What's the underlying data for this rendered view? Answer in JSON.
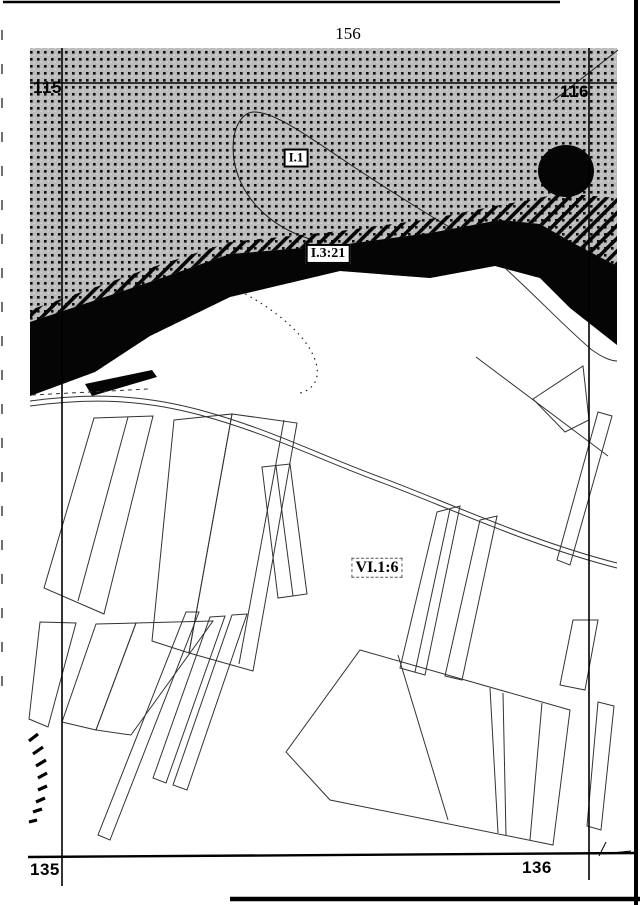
{
  "page": {
    "number": "156",
    "colors": {
      "paper": "#ffffff",
      "ink": "#000000",
      "halftone_bg": "#bcbcbc"
    }
  },
  "map": {
    "grid_labels": [
      {
        "name": "grid-label-115",
        "text": "115",
        "x": 33,
        "y": 79
      },
      {
        "name": "grid-label-116",
        "text": "116",
        "x": 560,
        "y": 83
      },
      {
        "name": "grid-label-135",
        "text": "135",
        "x": 30,
        "y": 861
      },
      {
        "name": "grid-label-136",
        "text": "136",
        "x": 522,
        "y": 859
      }
    ],
    "area_labels": [
      {
        "name": "region-label-i1",
        "text": "I.1",
        "cx": 296,
        "cy": 158,
        "style": "solid",
        "fs": 13
      },
      {
        "name": "region-label-i3-21",
        "text": "I.3:21",
        "cx": 328,
        "cy": 254,
        "style": "solid",
        "fs": 14
      },
      {
        "name": "region-label-vi1-6",
        "text": "VI.1:6",
        "cx": 377,
        "cy": 568,
        "style": "dashed",
        "fs": 16
      }
    ],
    "features": [
      {
        "name": "halftone-region",
        "type": "polygon",
        "points": "30,48 617,48 617,345 570,308 540,278 495,266 430,278 340,271 230,297 150,336 95,372 30,396",
        "fill": "dots"
      },
      {
        "name": "hill-contour-line",
        "type": "path",
        "d": "M310,239 C268,226 240,196 234,160 C230,130 241,113 253,112 C272,111 302,132 342,159 C385,188 432,217 456,231",
        "stroke": "#1a1a1a",
        "sw": 1
      },
      {
        "name": "corner-boundary-line",
        "type": "line",
        "x1": 553,
        "y1": 101,
        "x2": 618,
        "y2": 50,
        "stroke": "#1a1a1a",
        "sw": 1
      },
      {
        "name": "shore-hatch-band",
        "type": "polygon",
        "points": "30,310 150,268 230,242 340,231 430,219 500,205 535,199 560,193 617,198 617,266 575,244 540,224 500,220 430,233 340,245 230,254 150,282 30,322",
        "fill": "hatch"
      },
      {
        "name": "river-band",
        "type": "polygon",
        "points": "30,322 150,282 230,254 340,245 430,233 500,220 540,224 575,244 617,266 617,345 570,308 540,278 495,266 430,278 340,271 230,297 150,336 95,372 30,396",
        "fill": "#050505"
      },
      {
        "name": "bank-dash",
        "type": "polygon",
        "points": "85,384 152,370 157,377 92,396",
        "fill": "#050505"
      },
      {
        "name": "pond-blob",
        "type": "ellipse",
        "cx": 566,
        "cy": 171,
        "rx": 28,
        "ry": 26,
        "fill": "#050505"
      },
      {
        "name": "marsh-dotted-arc",
        "type": "path",
        "d": "M240,291 C285,315 312,342 317,367 C319,381 312,390 300,393",
        "stroke": "#222222",
        "sw": 1.2,
        "dash": "1.5 4.5"
      },
      {
        "name": "road-upper-line",
        "type": "path",
        "d": "M30,401 C90,393 140,394 200,410 C270,429 320,455 380,477 C440,499 530,541 617,563",
        "stroke": "#333333",
        "sw": 1
      },
      {
        "name": "road-lower-line",
        "type": "path",
        "d": "M30,406 C90,398 140,399 200,415 C270,434 320,460 380,482 C440,504 530,546 617,568",
        "stroke": "#333333",
        "sw": 1
      },
      {
        "name": "roadside-dashed-line",
        "type": "line",
        "x1": 32,
        "y1": 395,
        "x2": 148,
        "y2": 389,
        "stroke": "#333333",
        "sw": 1,
        "dash": "4 4"
      },
      {
        "name": "field-boundary-line",
        "type": "path",
        "d": "M505,268 C540,300 568,330 592,350 C603,358 612,361 617,361",
        "stroke": "#333333",
        "sw": 1
      },
      {
        "name": "diagonal-boundary-line",
        "type": "line",
        "x1": 476,
        "y1": 357,
        "x2": 608,
        "y2": 456,
        "stroke": "#333333",
        "sw": 1
      },
      {
        "name": "parcel",
        "type": "polygon",
        "points": "94,418 153,416 104,614 44,588",
        "stroke": "#333333",
        "sw": 1
      },
      {
        "name": "parcel-divider",
        "type": "line",
        "x1": 128,
        "y1": 417,
        "x2": 78,
        "y2": 601,
        "stroke": "#333333",
        "sw": 1
      },
      {
        "name": "parcel",
        "type": "polygon",
        "points": "174,420 232,414 189,653 152,641",
        "stroke": "#333333",
        "sw": 1
      },
      {
        "name": "parcel",
        "type": "polygon",
        "points": "232,414 297,423 253,671 189,653",
        "stroke": "#333333",
        "sw": 1
      },
      {
        "name": "parcel-divider",
        "type": "line",
        "x1": 284,
        "y1": 420,
        "x2": 239,
        "y2": 664,
        "stroke": "#333333",
        "sw": 1
      },
      {
        "name": "parcel",
        "type": "polygon",
        "points": "40,622 76,623 48,727 29,719",
        "stroke": "#333333",
        "sw": 1
      },
      {
        "name": "parcel",
        "type": "polygon",
        "points": "96,624 136,623 96,730 62,722",
        "stroke": "#333333",
        "sw": 1
      },
      {
        "name": "parcel",
        "type": "polygon",
        "points": "136,623 213,621 131,735 96,730",
        "stroke": "#333333",
        "sw": 1
      },
      {
        "name": "parcel-sliver",
        "type": "polygon",
        "points": "186,612 199,612 110,840 98,835",
        "stroke": "#333333",
        "sw": 1
      },
      {
        "name": "parcel-sliver",
        "type": "polygon",
        "points": "210,617 225,616 166,783 153,778",
        "stroke": "#333333",
        "sw": 1
      },
      {
        "name": "parcel-sliver",
        "type": "polygon",
        "points": "232,615 247,614 187,790 173,785",
        "stroke": "#333333",
        "sw": 1
      },
      {
        "name": "parcel",
        "type": "polygon",
        "points": "262,467 290,464 307,594 278,598",
        "stroke": "#333333",
        "sw": 1
      },
      {
        "name": "parcel-divider",
        "type": "line",
        "x1": 276,
        "y1": 466,
        "x2": 293,
        "y2": 596,
        "stroke": "#333333",
        "sw": 1
      },
      {
        "name": "parcel",
        "type": "polygon",
        "points": "437,512 460,506 425,675 400,668",
        "stroke": "#333333",
        "sw": 1
      },
      {
        "name": "parcel-divider",
        "type": "line",
        "x1": 450,
        "y1": 509,
        "x2": 415,
        "y2": 672,
        "stroke": "#333333",
        "sw": 1
      },
      {
        "name": "parcel",
        "type": "polygon",
        "points": "480,520 497,516 462,680 445,676",
        "stroke": "#333333",
        "sw": 1
      },
      {
        "name": "parcel",
        "type": "polygon",
        "points": "598,412 612,416 570,565 557,560",
        "stroke": "#333333",
        "sw": 1
      },
      {
        "name": "parcel",
        "type": "polygon",
        "points": "573,620 598,620 585,690 560,685",
        "stroke": "#333333",
        "sw": 1
      },
      {
        "name": "parcel-triangle",
        "type": "polygon",
        "points": "533,399 583,366 589,420 565,432",
        "stroke": "#333333",
        "sw": 1
      },
      {
        "name": "parcel",
        "type": "polygon",
        "points": "598,702 614,706 601,830 587,826",
        "stroke": "#333333",
        "sw": 1
      },
      {
        "name": "field-block",
        "type": "polygon",
        "points": "360,650 570,710 553,845 330,800 286,752",
        "stroke": "#333333",
        "sw": 1
      },
      {
        "name": "field-block-divider",
        "type": "line",
        "x1": 398,
        "y1": 655,
        "x2": 448,
        "y2": 820,
        "stroke": "#333333",
        "sw": 1
      },
      {
        "name": "field-block-divider",
        "type": "line",
        "x1": 490,
        "y1": 688,
        "x2": 498,
        "y2": 833,
        "stroke": "#333333",
        "sw": 1
      },
      {
        "name": "field-block-divider",
        "type": "line",
        "x1": 503,
        "y1": 693,
        "x2": 506,
        "y2": 835,
        "stroke": "#333333",
        "sw": 1
      },
      {
        "name": "field-block-divider",
        "type": "line",
        "x1": 542,
        "y1": 703,
        "x2": 530,
        "y2": 840,
        "stroke": "#333333",
        "sw": 1
      },
      {
        "name": "slope-hatch-mark",
        "type": "line",
        "x1": 29,
        "y1": 741,
        "x2": 38,
        "y2": 734,
        "stroke": "#000000",
        "sw": 3.2
      },
      {
        "name": "slope-hatch-mark",
        "type": "line",
        "x1": 33,
        "y1": 754,
        "x2": 43,
        "y2": 747,
        "stroke": "#000000",
        "sw": 3.2
      },
      {
        "name": "slope-hatch-mark",
        "type": "line",
        "x1": 36,
        "y1": 766,
        "x2": 46,
        "y2": 760,
        "stroke": "#000000",
        "sw": 3.2
      },
      {
        "name": "slope-hatch-mark",
        "type": "line",
        "x1": 38,
        "y1": 778,
        "x2": 47,
        "y2": 773,
        "stroke": "#000000",
        "sw": 3.2
      },
      {
        "name": "slope-hatch-mark",
        "type": "line",
        "x1": 38,
        "y1": 790,
        "x2": 47,
        "y2": 786,
        "stroke": "#000000",
        "sw": 3.2
      },
      {
        "name": "slope-hatch-mark",
        "type": "line",
        "x1": 36,
        "y1": 802,
        "x2": 45,
        "y2": 798,
        "stroke": "#000000",
        "sw": 3.2
      },
      {
        "name": "slope-hatch-mark",
        "type": "line",
        "x1": 33,
        "y1": 812,
        "x2": 42,
        "y2": 809,
        "stroke": "#000000",
        "sw": 3.2
      },
      {
        "name": "slope-hatch-mark",
        "type": "line",
        "x1": 29,
        "y1": 822,
        "x2": 37,
        "y2": 820,
        "stroke": "#000000",
        "sw": 3.2
      },
      {
        "name": "grid-line-vertical-left",
        "type": "line",
        "x1": 62,
        "y1": 48,
        "x2": 62,
        "y2": 886,
        "stroke": "#000000",
        "sw": 1.6
      },
      {
        "name": "grid-line-vertical-right",
        "type": "line",
        "x1": 589,
        "y1": 48,
        "x2": 589,
        "y2": 880,
        "stroke": "#000000",
        "sw": 1.6
      },
      {
        "name": "grid-line-horizontal-top",
        "type": "line",
        "x1": 30,
        "y1": 83,
        "x2": 617,
        "y2": 83,
        "stroke": "#000000",
        "sw": 1.6
      },
      {
        "name": "grid-line-horizontal-bottom",
        "type": "line",
        "x1": 28,
        "y1": 857,
        "x2": 637,
        "y2": 853,
        "stroke": "#000000",
        "sw": 2.4
      },
      {
        "name": "corner-tick",
        "type": "line",
        "x1": 606,
        "y1": 842,
        "x2": 599,
        "y2": 856,
        "stroke": "#000000",
        "sw": 1
      },
      {
        "name": "corner-tick",
        "type": "line",
        "x1": 612,
        "y1": 853,
        "x2": 631,
        "y2": 851,
        "stroke": "#000000",
        "sw": 1
      },
      {
        "name": "page-border-top",
        "type": "line",
        "x1": 3,
        "y1": 2,
        "x2": 560,
        "y2": 2,
        "stroke": "#000000",
        "sw": 2.4
      },
      {
        "name": "page-border-right",
        "type": "line",
        "x1": 636,
        "y1": 0,
        "x2": 636,
        "y2": 905,
        "stroke": "#000000",
        "sw": 4
      },
      {
        "name": "page-border-left",
        "type": "line",
        "x1": 2,
        "y1": 30,
        "x2": 2,
        "y2": 700,
        "stroke": "#333333",
        "sw": 1.4,
        "dash": "10 24"
      },
      {
        "name": "page-border-bottom",
        "type": "line",
        "x1": 230,
        "y1": 899,
        "x2": 640,
        "y2": 899,
        "stroke": "#000000",
        "sw": 4.5
      }
    ]
  }
}
